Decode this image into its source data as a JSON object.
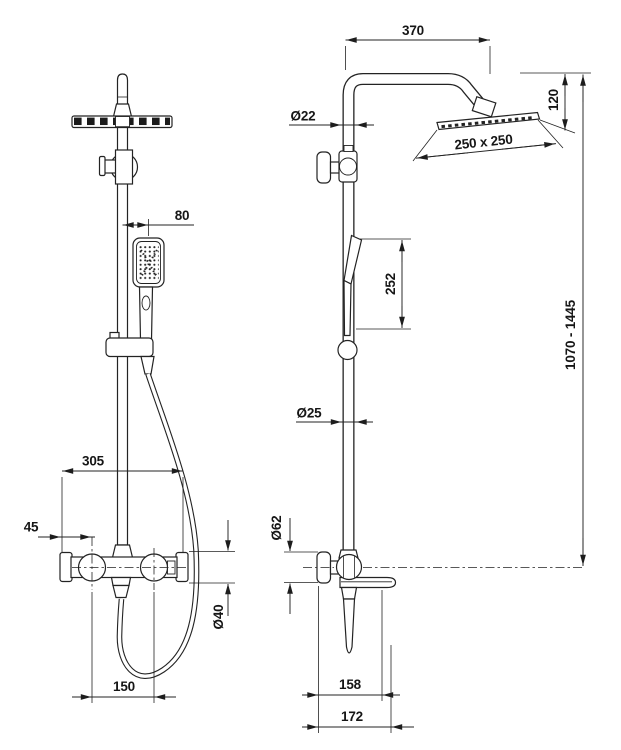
{
  "page": {
    "background": "#ffffff",
    "line_color": "#232323",
    "content_kind": "shower-column-technical-drawing"
  },
  "dimensions": {
    "front_view": {
      "handshower_offset": "80",
      "mixer_width": "305",
      "mixer_left_offset": "45",
      "mixer_body_diameter": "Ø40",
      "knob_spacing": "150"
    },
    "side_view": {
      "arm_reach": "370",
      "head_drop": "120",
      "head_size": "250 x 250",
      "upper_pipe_diameter": "Ø22",
      "handshower_length": "252",
      "column_height_range": "1070 - 1445",
      "lower_pipe_diameter": "Ø25",
      "wall_flange_diameter": "Ø62",
      "wall_to_spout": "158",
      "wall_to_front": "172"
    }
  }
}
